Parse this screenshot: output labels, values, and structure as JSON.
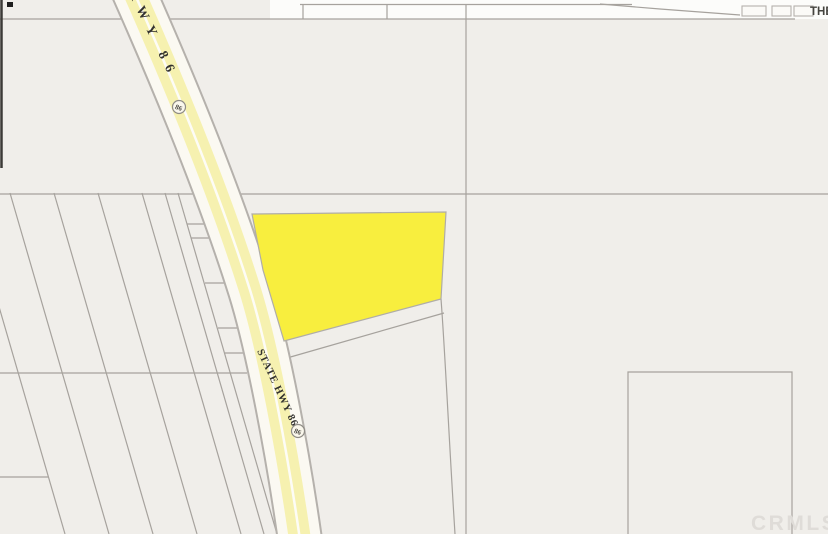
{
  "map": {
    "type": "parcel-map",
    "labels": {
      "highway_top": "HWY 86",
      "highway_bottom": "STATE HWY 86",
      "route_shield": "86",
      "top_right": "THE",
      "watermark": "CRMLS"
    },
    "colors": {
      "background": "#f0eeea",
      "top_band_white": "#fcfcfa",
      "highlight_parcel_fill": "#f8ee3e",
      "road_yellow": "#f6f1b0",
      "road_cream": "#fbf9f2",
      "road_centerline": "#fdfcf6",
      "road_casing": "#b5b1ac",
      "parcel_line": "#a6a29d",
      "structure_fill": "#fbfaf7",
      "label_text": "#33322f",
      "shield_text": "#4a4842",
      "top_right_text": "#45443f",
      "watermark_text": "#dfdcd8",
      "scan_edge_dark": "#3c3a37"
    }
  }
}
